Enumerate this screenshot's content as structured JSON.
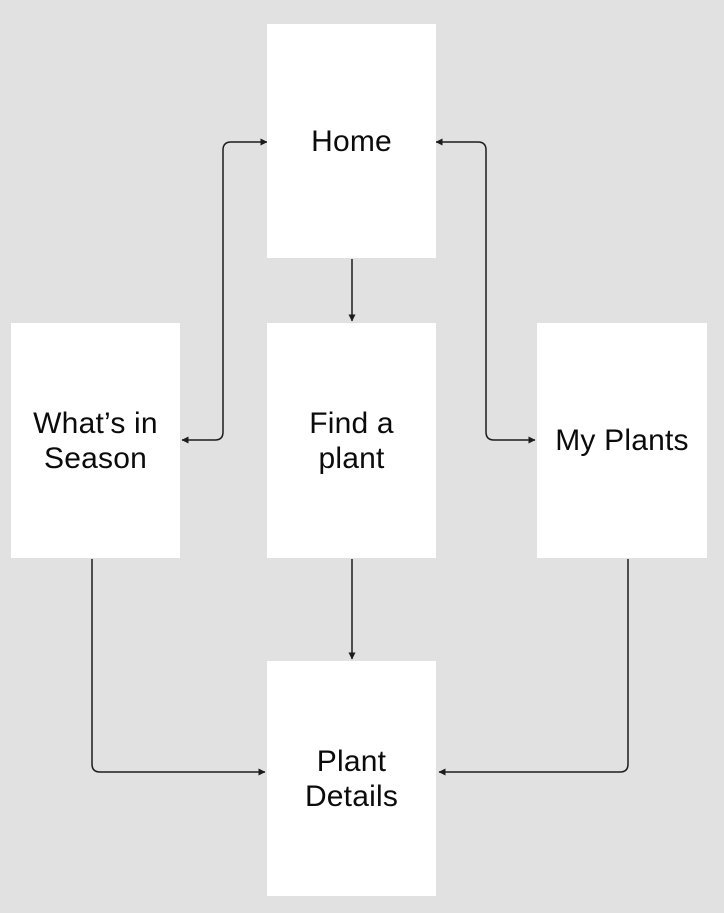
{
  "diagram": {
    "title": "plant-app-navigation-flow",
    "colors": {
      "background": "#e1e1e1",
      "node_fill": "#ffffff",
      "connector": "#1c1c1c",
      "text": "#0b0b0b"
    },
    "nodes": [
      {
        "id": "home",
        "label": "Home",
        "x": 267,
        "y": 24,
        "w": 169,
        "h": 234
      },
      {
        "id": "whats-in-season",
        "label": "What’s in\nSeason",
        "x": 11,
        "y": 323,
        "w": 169,
        "h": 235
      },
      {
        "id": "find-a-plant",
        "label": "Find a\nplant",
        "x": 267,
        "y": 323,
        "w": 169,
        "h": 235
      },
      {
        "id": "my-plants",
        "label": "My Plants",
        "x": 537,
        "y": 323,
        "w": 170,
        "h": 235
      },
      {
        "id": "plant-details",
        "label": "Plant\nDetails",
        "x": 267,
        "y": 661,
        "w": 169,
        "h": 235
      }
    ],
    "edges": [
      {
        "from": "home",
        "to": "whats-in-season",
        "arrow_start": true,
        "arrow_end": true,
        "points": [
          [
            267,
            142
          ],
          [
            223,
            142
          ],
          [
            223,
            440
          ],
          [
            182,
            440
          ]
        ]
      },
      {
        "from": "home",
        "to": "my-plants",
        "arrow_start": true,
        "arrow_end": true,
        "points": [
          [
            436,
            142
          ],
          [
            486,
            142
          ],
          [
            486,
            440
          ],
          [
            535,
            440
          ]
        ]
      },
      {
        "from": "home",
        "to": "find-a-plant",
        "arrow_start": false,
        "arrow_end": true,
        "points": [
          [
            352,
            259
          ],
          [
            352,
            321
          ]
        ]
      },
      {
        "from": "find-a-plant",
        "to": "plant-details",
        "arrow_start": false,
        "arrow_end": true,
        "points": [
          [
            352,
            559
          ],
          [
            352,
            659
          ]
        ]
      },
      {
        "from": "whats-in-season",
        "to": "plant-details",
        "arrow_start": false,
        "arrow_end": true,
        "points": [
          [
            92,
            559
          ],
          [
            92,
            772
          ],
          [
            265,
            772
          ]
        ]
      },
      {
        "from": "my-plants",
        "to": "plant-details",
        "arrow_start": false,
        "arrow_end": true,
        "points": [
          [
            628,
            559
          ],
          [
            628,
            772
          ],
          [
            439,
            772
          ]
        ]
      }
    ],
    "style": {
      "corner_radius": 8,
      "line_width": 1.5
    }
  }
}
